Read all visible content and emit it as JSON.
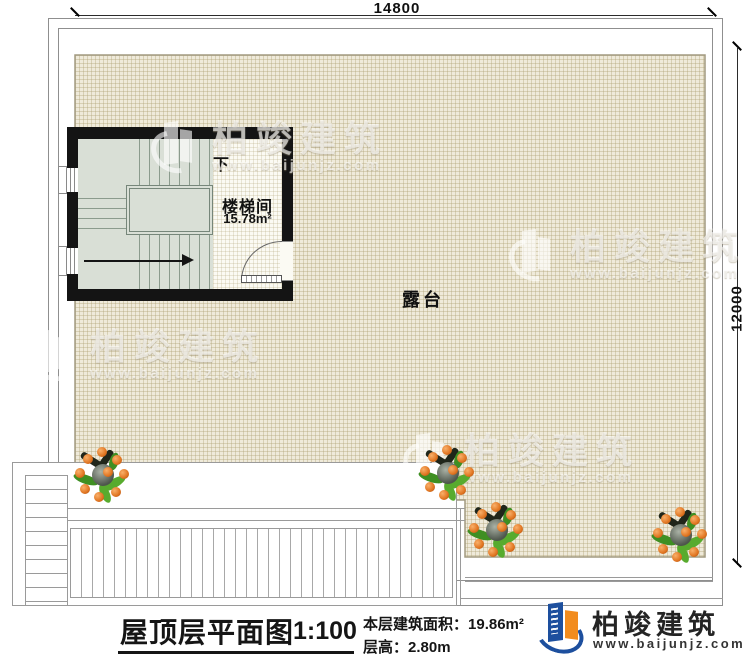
{
  "dimensions": {
    "top": "14800",
    "right": "12000"
  },
  "plan": {
    "terrace_label": "露台",
    "stairwell": {
      "direction_label": "下",
      "room_name": "楼梯间",
      "room_area": "15.78m²"
    }
  },
  "watermark": {
    "brand": "柏竣建筑",
    "url": "www.baijunjz.com"
  },
  "footer": {
    "title": "屋顶层平面图",
    "scale": "1:100",
    "area_label": "本层建筑面积：",
    "area_value": "19.86m²",
    "floor_height_label": "层高：",
    "floor_height_value": "2.80m",
    "logo_brand": "柏竣建筑",
    "logo_url": "www.baijunjz.com"
  },
  "colors": {
    "terrace_fill": "#efeada",
    "stair_fill": "#d9dfd6",
    "wall": "#141414",
    "logo_blue": "#1d4f9e",
    "logo_orange": "#f28c1e"
  }
}
